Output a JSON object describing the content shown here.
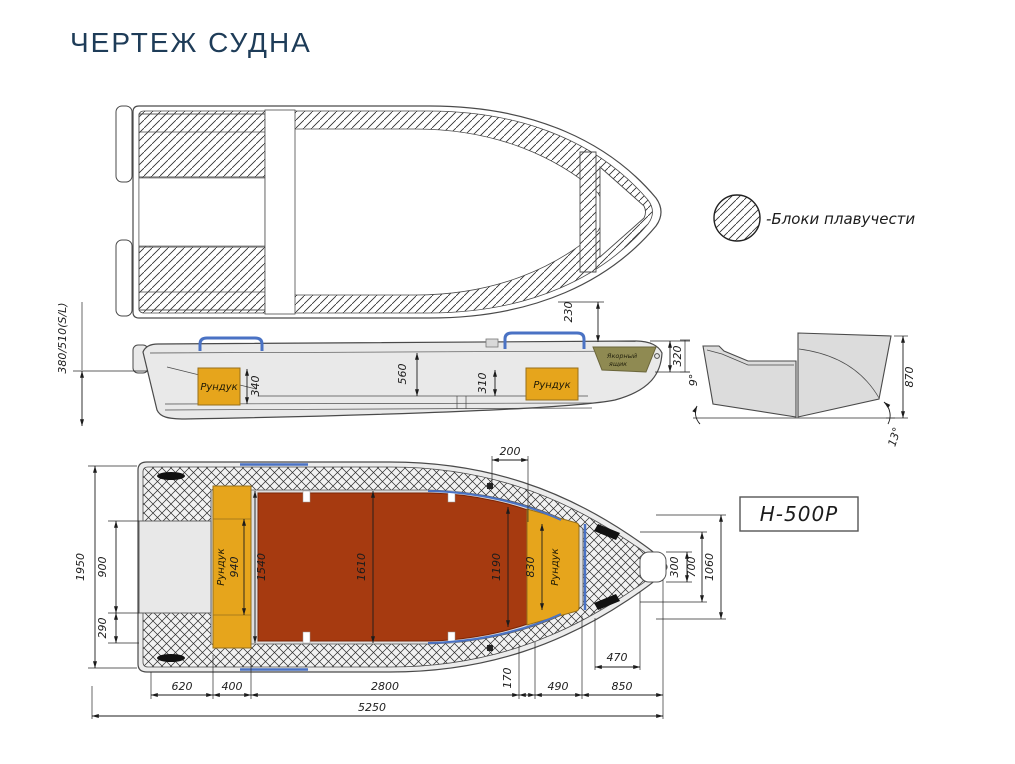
{
  "title": "ЧЕРТЕЖ СУДНА",
  "legend": {
    "label": "-Блоки плавучести"
  },
  "model": {
    "badge": "H-500P"
  },
  "colors": {
    "title_navy": "#1e3c58",
    "accent_blue": "#4a72c4",
    "floor_red": "#a63a10",
    "locker_orange": "#e6a51c",
    "anchor_olive": "#8f8a52",
    "hull_gray": "#ebebeb"
  },
  "side_view": {
    "labels": {
      "aft_locker": "Рундук",
      "fwd_locker": "Рундук",
      "anchor_line1": "Якорный",
      "anchor_line2": "ящик"
    },
    "dims": {
      "freeboard": "380/510(S/L)",
      "d230": "230",
      "d560": "560",
      "d310": "310",
      "d340": "340",
      "d320": "320"
    }
  },
  "section_view": {
    "dims": {
      "hull_height": "870",
      "deadrise_angle": "9°",
      "bow_angle": "13°"
    }
  },
  "plan_view": {
    "labels": {
      "aft_locker": "Рундук",
      "fwd_locker": "Рундук"
    },
    "dims": {
      "beam": "1950",
      "d900": "900",
      "d290": "290",
      "d940": "940",
      "d1540": "1540",
      "d1610": "1610",
      "d1190": "1190",
      "d830": "830",
      "d200": "200",
      "d300": "300",
      "d700": "700",
      "d1060": "1060",
      "d470": "470",
      "d170": "170",
      "d620": "620",
      "d400": "400",
      "d2800": "2800",
      "d490": "490",
      "d850": "850",
      "overall_length": "5250"
    }
  }
}
